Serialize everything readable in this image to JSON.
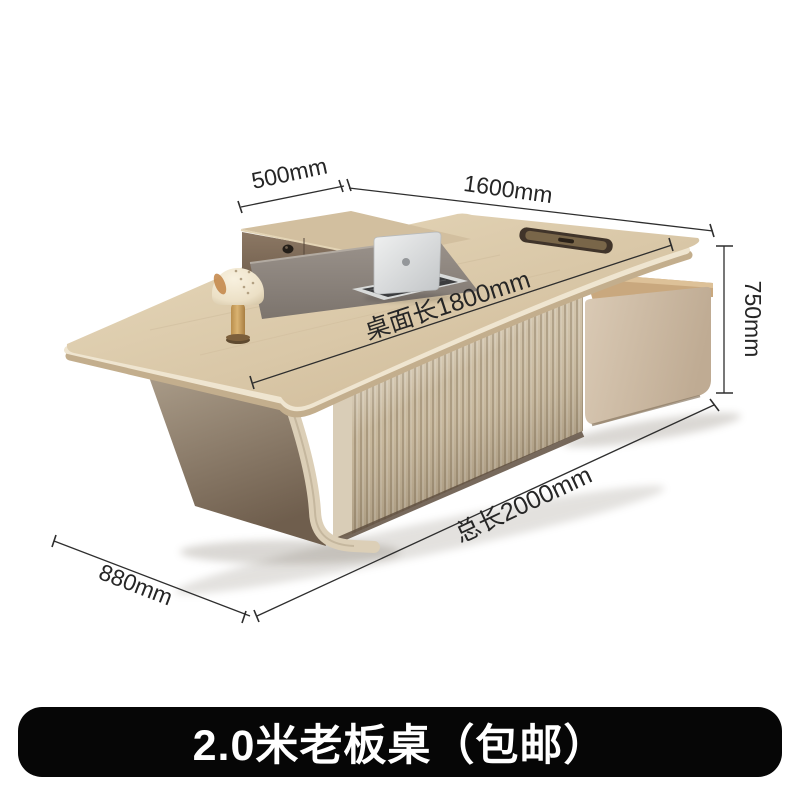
{
  "banner": {
    "title": "2.0米老板桌（包邮）",
    "bg_color": "#060606",
    "text_color": "#ffffff"
  },
  "dimensions": {
    "return_depth": "500mm",
    "main_width": "1600mm",
    "height": "750mm",
    "desktop_length": "桌面长1800mm",
    "total_length": "总长2000mm",
    "side_depth": "880mm"
  },
  "scene": {
    "subject": "L-shaped executive boss desk with side cabinet, fluted front panel, laptop and mushroom lamp",
    "colors": {
      "desk_wood": "#d9c7a7",
      "edge_cream": "#efe5d0",
      "fluted_panel": "#c6b69a",
      "side_cabinet": "#cdbba4",
      "leg_taupe": "#8d7c6a",
      "inlay_gray": "#8f8780",
      "laptop_silver": "#d9dbdb",
      "dimension_line": "#2e2e2e"
    }
  }
}
